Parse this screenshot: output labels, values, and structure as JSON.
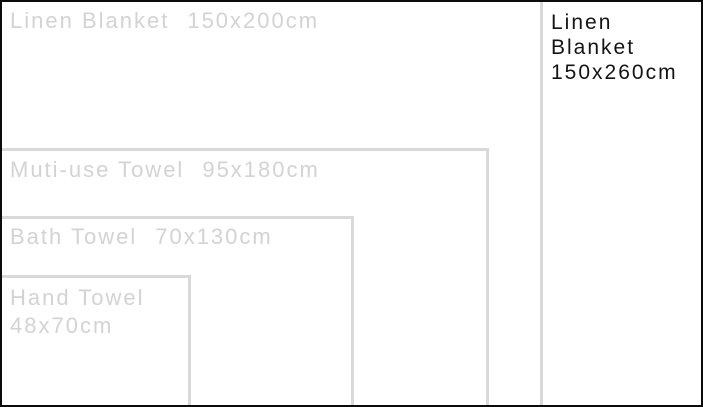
{
  "stage": {
    "width_px": 703,
    "height_px": 407
  },
  "scale_px_per_cm": 2.705,
  "colors": {
    "frame": "#0b0b0b",
    "outline": "#d9d9d9",
    "muted_text": "#d3d3d3",
    "dark_text": "#141414",
    "background": "#ffffff"
  },
  "items": [
    {
      "id": "linen-blanket-150x260",
      "name": "Linen Blanket",
      "size": "150x260cm",
      "label_lines": [
        "Linen",
        "Blanket",
        "150x260cm"
      ],
      "width_cm": 260,
      "height_cm": 150,
      "style": "frame"
    },
    {
      "id": "linen-blanket-150x200",
      "name": "Linen Blanket",
      "size": "150x200cm",
      "width_cm": 200,
      "height_cm": 150,
      "style": "outline"
    },
    {
      "id": "muti-use-towel-95x180",
      "name": "Muti-use Towel",
      "size": "95x180cm",
      "width_cm": 180,
      "height_cm": 95,
      "style": "outline"
    },
    {
      "id": "bath-towel-70x130",
      "name": "Bath Towel",
      "size": "70x130cm",
      "width_cm": 130,
      "height_cm": 70,
      "style": "outline"
    },
    {
      "id": "hand-towel-48x70",
      "name": "Hand Towel",
      "size": "48x70cm",
      "width_cm": 70,
      "height_cm": 48,
      "style": "outline"
    }
  ]
}
